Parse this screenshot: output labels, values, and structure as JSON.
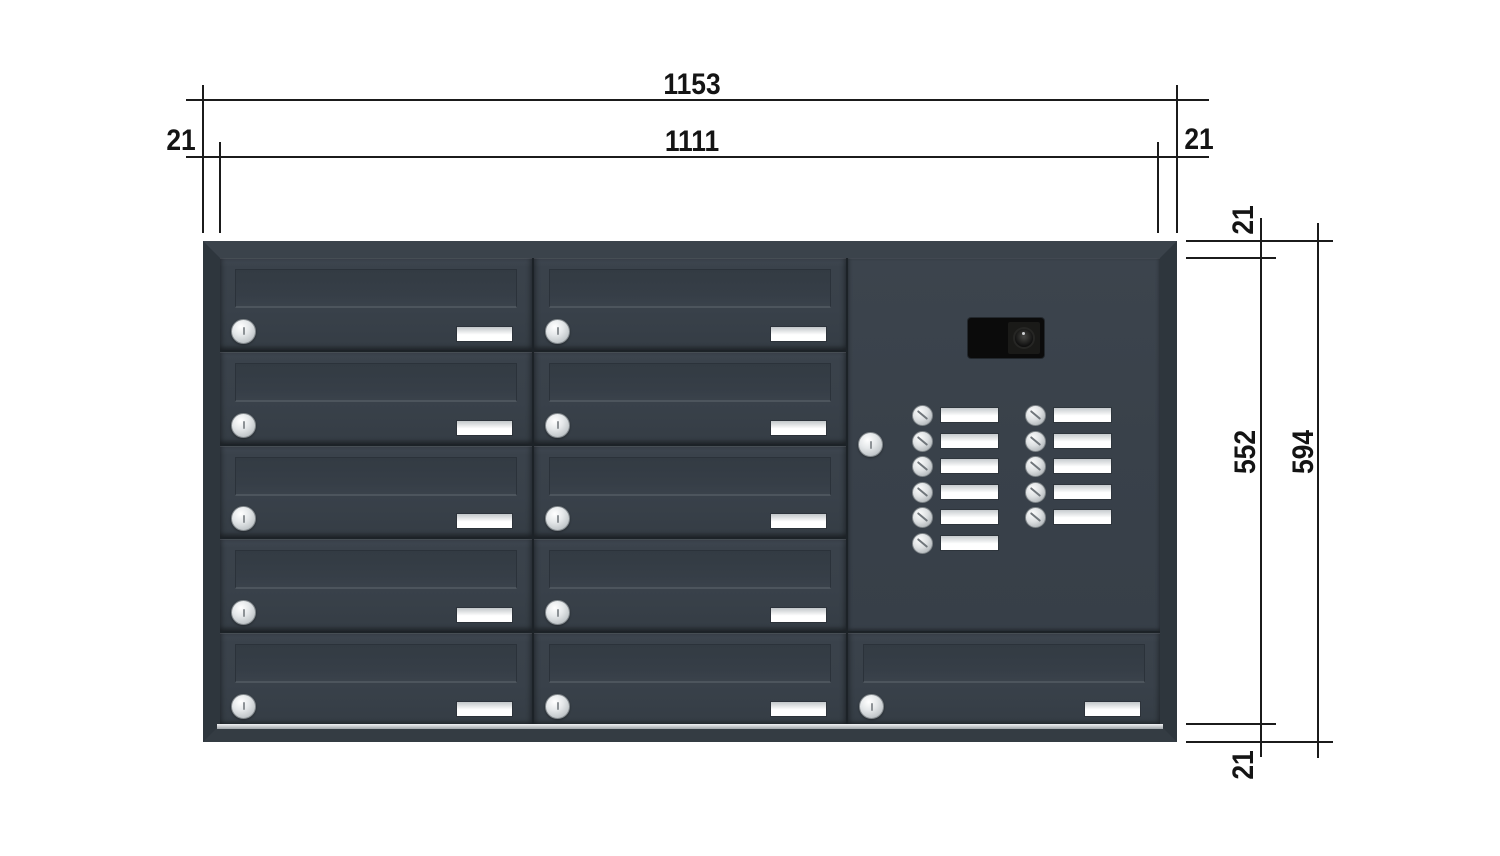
{
  "dimensions": {
    "top_outer_width": "1153",
    "top_inner_width": "1111",
    "top_margin_left": "21",
    "top_margin_right": "21",
    "side_margin_top": "21",
    "side_inner_height": "552",
    "side_outer_height": "594",
    "side_margin_bottom": "21"
  },
  "cabinet": {
    "colors": {
      "body": "#39414a",
      "frame": "#343c44",
      "seam": "#1c2227",
      "lock": "#d9dcde",
      "name_plate": "#ffffff",
      "base_trim": "#c6cacd",
      "camera_module": "#0b0b0b"
    },
    "left_column_doors": 5,
    "middle_column_doors": 5,
    "bottom_right_doors": 1,
    "intercom": {
      "bell_buttons_left": 6,
      "bell_buttons_right": 5,
      "has_camera": true,
      "has_lock": true
    }
  }
}
